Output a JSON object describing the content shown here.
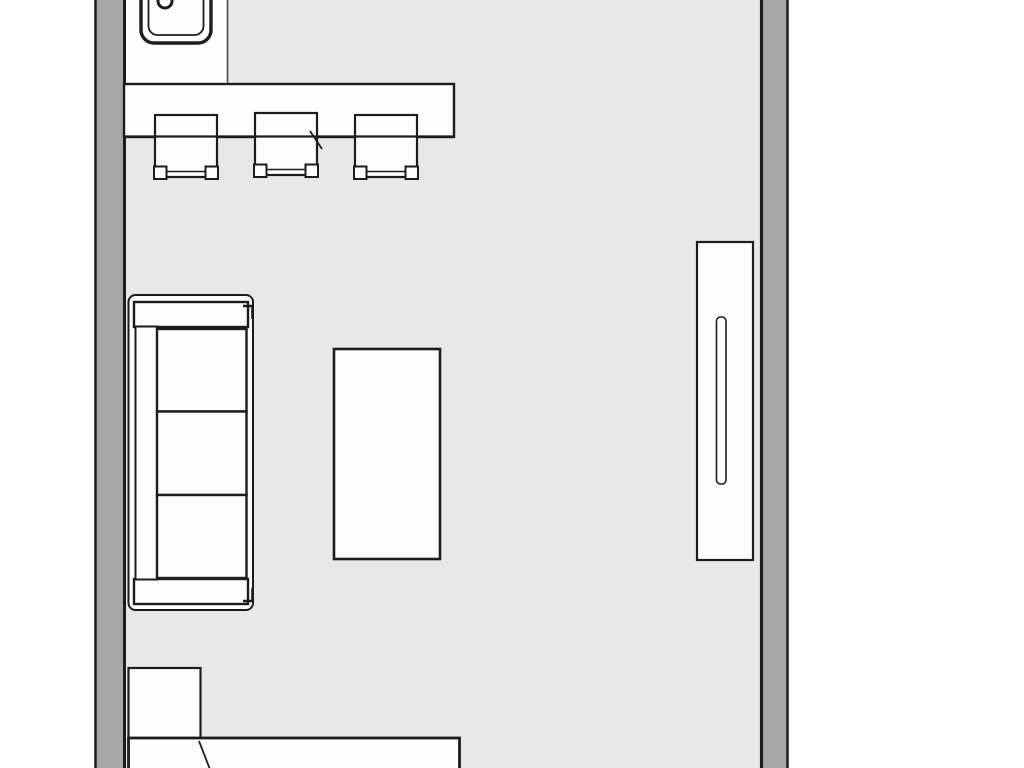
{
  "meta": {
    "view": "floor-plan",
    "canvas_w": 1024,
    "canvas_h": 768
  },
  "palette": {
    "background": "#ffffff",
    "floor": "#e8e8e6",
    "wall": "#a8a8a8",
    "ink": "#1c1c1c",
    "ink_soft": "#4a4a4a",
    "fill": "#fdfdfd"
  },
  "scene": {
    "floor": {
      "x": 124,
      "y": 0,
      "w": 637,
      "h": 768
    },
    "walls": [
      {
        "name": "wall-left",
        "band": {
          "x": 96,
          "y": 0,
          "w": 28.5,
          "h": 768
        },
        "edges": [
          {
            "x1": 95.5,
            "y1": 0,
            "x2": 95.5,
            "y2": 768,
            "sw": 2.5
          },
          {
            "x1": 124.5,
            "y1": 0,
            "x2": 124.5,
            "y2": 768,
            "sw": 3
          }
        ]
      },
      {
        "name": "wall-right",
        "band": {
          "x": 761,
          "y": 0,
          "w": 26.5,
          "h": 768
        },
        "edges": [
          {
            "x1": 761.5,
            "y1": 0,
            "x2": 761.5,
            "y2": 768,
            "sw": 3.2
          },
          {
            "x1": 787.5,
            "y1": 0,
            "x2": 787.5,
            "y2": 768,
            "sw": 2.5
          }
        ]
      }
    ],
    "zones": [
      {
        "name": "kitchen-zone",
        "rect": {
          "x": 126,
          "y": 0,
          "w": 101,
          "h": 85
        },
        "edge": {
          "x1": 227.5,
          "y1": 0,
          "x2": 227.5,
          "y2": 85,
          "sw": 1.6
        }
      }
    ],
    "furniture": [
      {
        "name": "bar-counter",
        "interactable": true,
        "shapes": [
          {
            "kind": "rect",
            "x": 124,
            "y": 84,
            "w": 330,
            "h": 53,
            "sw": 2.4
          }
        ]
      },
      {
        "name": "kitchen-sink",
        "interactable": true,
        "shapes": [
          {
            "kind": "rect",
            "x": 141,
            "y": -14,
            "w": 70,
            "h": 57,
            "rx": 13,
            "sw": 3.4
          },
          {
            "kind": "rect",
            "x": 148.5,
            "y": -9,
            "w": 55,
            "h": 44,
            "rx": 9,
            "sw": 1.8
          },
          {
            "kind": "circle",
            "cx": 165,
            "cy": 1,
            "r": 7,
            "sw": 3
          }
        ]
      },
      {
        "name": "bar-stool-1",
        "interactable": true,
        "shapes": [
          {
            "kind": "rect",
            "x": 155,
            "y": 115,
            "w": 62,
            "h": 62,
            "sw": 2.2
          },
          {
            "kind": "line",
            "x1": 167,
            "y1": 171.5,
            "x2": 205,
            "y2": 171.5,
            "sw": 1.6
          },
          {
            "kind": "rect",
            "x": 154,
            "y": 166.5,
            "w": 12.5,
            "h": 12.5,
            "sw": 2
          },
          {
            "kind": "rect",
            "x": 205.5,
            "y": 166.5,
            "w": 12.5,
            "h": 12.5,
            "sw": 2
          }
        ]
      },
      {
        "name": "bar-stool-2",
        "interactable": true,
        "shapes": [
          {
            "kind": "rect",
            "x": 255,
            "y": 113,
            "w": 62,
            "h": 62,
            "sw": 2.2
          },
          {
            "kind": "line",
            "x1": 267,
            "y1": 169.5,
            "x2": 305,
            "y2": 169.5,
            "sw": 1.6
          },
          {
            "kind": "rect",
            "x": 254,
            "y": 164.5,
            "w": 12.5,
            "h": 12.5,
            "sw": 2
          },
          {
            "kind": "rect",
            "x": 305.5,
            "y": 164.5,
            "w": 12.5,
            "h": 12.5,
            "sw": 2
          }
        ]
      },
      {
        "name": "bar-stool-3",
        "interactable": true,
        "shapes": [
          {
            "kind": "rect",
            "x": 355,
            "y": 115,
            "w": 62,
            "h": 62,
            "sw": 2.2
          },
          {
            "kind": "line",
            "x1": 367,
            "y1": 171.5,
            "x2": 405,
            "y2": 171.5,
            "sw": 1.6
          },
          {
            "kind": "rect",
            "x": 354,
            "y": 166.5,
            "w": 12.5,
            "h": 12.5,
            "sw": 2
          },
          {
            "kind": "rect",
            "x": 405.5,
            "y": 166.5,
            "w": 12.5,
            "h": 12.5,
            "sw": 2
          }
        ]
      },
      {
        "name": "counter-front-edge",
        "interactable": false,
        "shapes": [
          {
            "kind": "line",
            "x1": 124,
            "y1": 136.5,
            "x2": 454,
            "y2": 136.5,
            "sw": 2.2
          }
        ]
      },
      {
        "name": "pen-mark",
        "interactable": false,
        "shapes": [
          {
            "kind": "line",
            "x1": 310,
            "y1": 131,
            "x2": 322,
            "y2": 149,
            "sw": 1.8
          }
        ]
      },
      {
        "name": "sofa",
        "interactable": true,
        "shapes": [
          {
            "kind": "rect",
            "x": 128.5,
            "y": 295,
            "w": 124.5,
            "h": 315,
            "rx": 7,
            "sw": 2
          },
          {
            "kind": "rect",
            "x": 134,
            "y": 302,
            "w": 114,
            "h": 25,
            "sw": 2.4
          },
          {
            "kind": "rect",
            "x": 134,
            "y": 579,
            "w": 114,
            "h": 25,
            "sw": 2.4
          },
          {
            "kind": "rect",
            "x": 135.5,
            "y": 326.5,
            "w": 21.5,
            "h": 253,
            "sw": 2
          },
          {
            "kind": "rect",
            "x": 157,
            "y": 329,
            "w": 89.5,
            "h": 82.5,
            "sw": 2.4
          },
          {
            "kind": "rect",
            "x": 157,
            "y": 411.5,
            "w": 89.5,
            "h": 83.5,
            "sw": 2.4
          },
          {
            "kind": "rect",
            "x": 157,
            "y": 495,
            "w": 89.5,
            "h": 83,
            "sw": 2.4
          },
          {
            "kind": "path",
            "d": "M243,306 L252.5,306 L252.5,319",
            "sw": 2.6
          },
          {
            "kind": "path",
            "d": "M243,601 L252.5,601 L252.5,588",
            "sw": 2.6
          }
        ]
      },
      {
        "name": "coffee-table",
        "interactable": true,
        "shapes": [
          {
            "kind": "rect",
            "x": 334,
            "y": 349,
            "w": 106,
            "h": 210,
            "sw": 2.6
          }
        ]
      },
      {
        "name": "wardrobe",
        "interactable": true,
        "shapes": [
          {
            "kind": "rect",
            "x": 697,
            "y": 242,
            "w": 56,
            "h": 318,
            "sw": 2.2
          },
          {
            "kind": "rect",
            "x": 716.5,
            "y": 317,
            "w": 9.5,
            "h": 167,
            "rx": 4,
            "sw": 1.6
          }
        ]
      },
      {
        "name": "nightstand",
        "interactable": true,
        "shapes": [
          {
            "kind": "rect",
            "x": 128.5,
            "y": 668,
            "w": 72,
            "h": 71,
            "sw": 2.2
          }
        ]
      },
      {
        "name": "bed",
        "interactable": true,
        "shapes": [
          {
            "kind": "rect",
            "x": 128.5,
            "y": 738,
            "w": 331,
            "h": 60,
            "sw": 2.8
          },
          {
            "kind": "line",
            "x1": 199,
            "y1": 741,
            "x2": 211,
            "y2": 772,
            "sw": 1.8
          }
        ]
      }
    ]
  }
}
